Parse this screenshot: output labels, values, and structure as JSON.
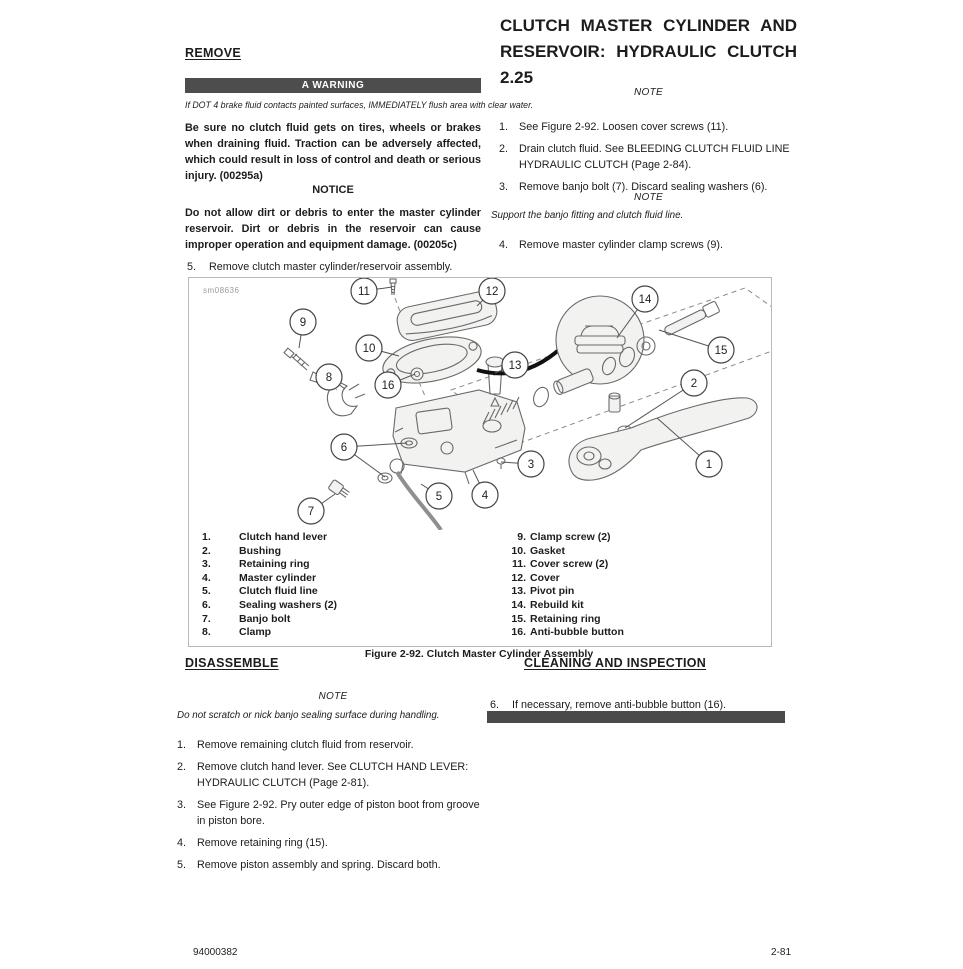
{
  "theme": {
    "banner-bg": "#4d4d4d",
    "bar-bg": "#4a4a4a"
  },
  "header": {
    "title_line1": "CLUTCH MASTER CYLINDER AND",
    "title_line2": "RESERVOIR: HYDRAULIC CLUTCH",
    "title_line3": "2.25"
  },
  "remove_section": {
    "heading": "REMOVE",
    "warning_banner": "A WARNING",
    "warning_italic": "If DOT 4 brake fluid contacts painted surfaces, IMMEDIATELY flush area with clear water.",
    "warning_bold": "Be sure no clutch fluid gets on tires, wheels or brakes when draining fluid. Traction can be adversely affected, which could result in loss of control and death or serious injury. (00295a)",
    "notice_heading": "NOTICE",
    "notice_body": "Do not allow dirt or debris to enter the master cylinder reservoir. Dirt or debris in the reservoir can cause improper operation and equipment damage. (00205c)",
    "step5_num": "5.",
    "step5_text": "Remove clutch master cylinder/reservoir assembly."
  },
  "remove_steps_right": {
    "note1": "NOTE",
    "steps": [
      {
        "num": "1.",
        "text": "See Figure 2-92. Loosen cover screws (11)."
      },
      {
        "num": "2.",
        "text": "Drain clutch fluid. See BLEEDING CLUTCH FLUID LINE HYDRAULIC CLUTCH (Page 2-84)."
      },
      {
        "num": "3.",
        "text": "Remove banjo bolt (7). Discard sealing washers (6)."
      }
    ],
    "note2": "NOTE",
    "note2_body": "Support the banjo fitting and clutch fluid line.",
    "step4_num": "4.",
    "step4_text": "Remove master cylinder clamp screws (9)."
  },
  "figure": {
    "watermark": "sm08636",
    "caption": "Figure 2-92. Clutch Master Cylinder Assembly",
    "callouts": [
      {
        "n": "11",
        "x": 175,
        "y": 13,
        "targets": [
          [
            203,
            9
          ]
        ]
      },
      {
        "n": "12",
        "x": 303,
        "y": 13,
        "targets": [
          [
            288,
            28
          ]
        ]
      },
      {
        "n": "9",
        "x": 114,
        "y": 44,
        "targets": [
          [
            110,
            70
          ]
        ]
      },
      {
        "n": "14",
        "x": 456,
        "y": 21,
        "targets": [
          [
            428,
            60
          ]
        ]
      },
      {
        "n": "10",
        "x": 180,
        "y": 70,
        "targets": [
          [
            210,
            78
          ]
        ]
      },
      {
        "n": "15",
        "x": 532,
        "y": 72,
        "targets": [
          [
            470,
            52
          ]
        ]
      },
      {
        "n": "13",
        "x": 326,
        "y": 87,
        "targets": [
          [
            306,
            95
          ]
        ]
      },
      {
        "n": "8",
        "x": 140,
        "y": 99,
        "targets": [
          [
            156,
            111
          ]
        ]
      },
      {
        "n": "16",
        "x": 199,
        "y": 107,
        "targets": [
          [
            226,
            96
          ]
        ]
      },
      {
        "n": "2",
        "x": 505,
        "y": 105,
        "targets": [
          [
            436,
            150
          ]
        ]
      },
      {
        "n": "6",
        "x": 155,
        "y": 169,
        "targets": [
          [
            218,
            165
          ],
          [
            196,
            199
          ]
        ]
      },
      {
        "n": "3",
        "x": 342,
        "y": 186,
        "targets": [
          [
            312,
            184
          ]
        ]
      },
      {
        "n": "1",
        "x": 520,
        "y": 186,
        "targets": [
          [
            468,
            140
          ]
        ]
      },
      {
        "n": "5",
        "x": 250,
        "y": 218,
        "targets": [
          [
            232,
            206
          ]
        ]
      },
      {
        "n": "4",
        "x": 296,
        "y": 217,
        "targets": [
          [
            284,
            192
          ]
        ]
      },
      {
        "n": "7",
        "x": 122,
        "y": 233,
        "targets": [
          [
            146,
            216
          ]
        ]
      }
    ],
    "legend_left": [
      {
        "num": "1.",
        "label": "Clutch hand lever"
      },
      {
        "num": "2.",
        "label": "Bushing"
      },
      {
        "num": "3.",
        "label": "Retaining ring"
      },
      {
        "num": "4.",
        "label": "Master cylinder"
      },
      {
        "num": "5.",
        "label": "Clutch fluid line"
      },
      {
        "num": "6.",
        "label": "Sealing washers (2)"
      },
      {
        "num": "7.",
        "label": "Banjo bolt"
      },
      {
        "num": "8.",
        "label": "Clamp"
      }
    ],
    "legend_right": [
      {
        "num": "9.",
        "label": "Clamp screw (2)"
      },
      {
        "num": "10.",
        "label": "Gasket"
      },
      {
        "num": "11.",
        "label": "Cover screw (2)"
      },
      {
        "num": "12.",
        "label": "Cover"
      },
      {
        "num": "13.",
        "label": "Pivot pin"
      },
      {
        "num": "14.",
        "label": "Rebuild kit"
      },
      {
        "num": "15.",
        "label": "Retaining ring"
      },
      {
        "num": "16.",
        "label": "Anti-bubble button"
      }
    ]
  },
  "disassemble_section": {
    "heading": "DISASSEMBLE",
    "note": "NOTE",
    "note_body": "Do not scratch or nick banjo sealing surface during handling.",
    "steps": [
      {
        "num": "1.",
        "text": "Remove remaining clutch fluid from reservoir."
      },
      {
        "num": "2.",
        "text": "Remove clutch hand lever. See CLUTCH HAND LEVER: HYDRAULIC CLUTCH (Page 2-81)."
      },
      {
        "num": "3.",
        "text": "See Figure 2-92. Pry outer edge of piston boot from groove in piston bore."
      },
      {
        "num": "4.",
        "text": "Remove retaining ring (15)."
      },
      {
        "num": "5.",
        "text": "Remove piston assembly and spring. Discard both."
      }
    ]
  },
  "cleaning_section": {
    "heading": "CLEANING AND INSPECTION",
    "step6_num": "6.",
    "step6_text": "If necessary, remove anti-bubble button (16)."
  },
  "footer": {
    "left": "94000382",
    "right": "2-81"
  }
}
